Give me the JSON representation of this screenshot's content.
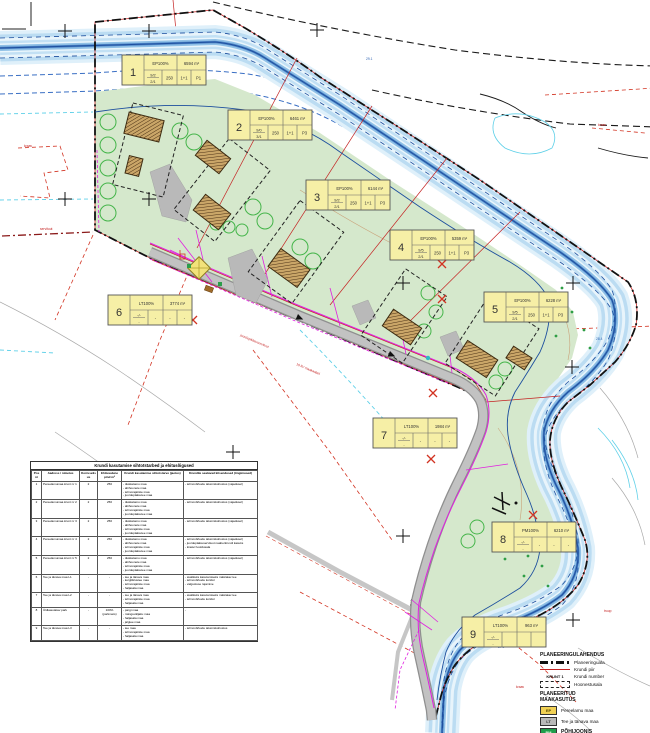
{
  "plots": [
    {
      "num": "1",
      "code": "EP100%",
      "area": "6594 m²",
      "fr_top": "9/2",
      "fr_bot": "2/1",
      "c2": "250",
      "c3": "1+1",
      "c4": "P1"
    },
    {
      "num": "2",
      "code": "EP100%",
      "area": "6461 m²",
      "fr_top": "9/0",
      "fr_bot": "3/1",
      "c2": "250",
      "c3": "1+1",
      "c4": "P3"
    },
    {
      "num": "3",
      "code": "EP100%",
      "area": "6144 m²",
      "fr_top": "9/2",
      "fr_bot": "2/1",
      "c2": "250",
      "c3": "1+1",
      "c4": "P3"
    },
    {
      "num": "4",
      "code": "EP100%",
      "area": "5359 m²",
      "fr_top": "9/5",
      "fr_bot": "2/1",
      "c2": "250",
      "c3": "1+1",
      "c4": "P3"
    },
    {
      "num": "5",
      "code": "EP100%",
      "area": "6228 m²",
      "fr_top": "9/5",
      "fr_bot": "2/1",
      "c2": "250",
      "c3": "1+1",
      "c4": "P3"
    },
    {
      "num": "6",
      "code": "LT100%",
      "area": "3774 m²",
      "fr_top": "-/-",
      "fr_bot": "-",
      "c2": "-",
      "c3": "-",
      "c4": "-"
    },
    {
      "num": "7",
      "code": "LT100%",
      "area": "1984 m²",
      "fr_top": "-/-",
      "fr_bot": "-",
      "c2": "-",
      "c3": "-",
      "c4": "-"
    },
    {
      "num": "8",
      "code": "PM100%",
      "area": "6210 m²",
      "fr_top": "-/-",
      "fr_bot": "-",
      "c2": "-",
      "c3": "-",
      "c4": "-"
    },
    {
      "num": "9",
      "code": "LT100%",
      "area": "963 m²",
      "fr_top": "-/-",
      "fr_bot": "-",
      "c2": "",
      "c3": "",
      "c4": ""
    }
  ],
  "table": {
    "title": "Krundi kasutamise sihtotstarbed ja ehitusõigused",
    "headers": [
      "Pos nr",
      "Aadress / nimetus",
      "Korruselisus",
      "Ehitusalune pind m²",
      "Krundi kasutamise sihtotstarve (jaotus)",
      "Krundile seatavad kitsendused (tingimused)"
    ],
    "rows": [
      [
        "1",
        "Pereelamumaa krunt nr 1",
        "2",
        "250",
        "- üksikelamu maa\n- abihoonete maa\n- tehnorajatiste maa\n- juurdepääsutee maa",
        "- tehnovõrkude talumiskohustus (vajadusel)"
      ],
      [
        "2",
        "Pereelamumaa krunt nr 2",
        "2",
        "250",
        "- üksikelamu maa\n- abihoonete maa\n- tehnorajatiste maa\n- juurdepääsutee maa",
        "- tehnovõrkude talumiskohustus (vajadusel)"
      ],
      [
        "3",
        "Pereelamumaa krunt nr 3",
        "2",
        "250",
        "- üksikelamu maa\n- abihoonete maa\n- tehnorajatiste maa\n- juurdepääsutee maa",
        "- tehnovõrkude talumiskohustus (vajadusel)"
      ],
      [
        "4",
        "Pereelamumaa krunt nr 4",
        "2",
        "250",
        "- üksikelamu maa\n- abihoonete maa\n- tehnorajatiste maa\n- juurdepääsutee maa",
        "- tehnovõrkude talumiskohustus (vajadusel)\n- juurdepääsuservituut naaberkrundi kasuks\n- kraavi hooldusala"
      ],
      [
        "5",
        "Pereelamumaa krunt nr 5",
        "2",
        "250",
        "- üksikelamu maa\n- abihoonete maa\n- tehnorajatiste maa\n- juurdepääsutee maa",
        "- tehnovõrkude talumiskohustus (vajadusel)"
      ],
      [
        "6",
        "Tee ja tänava maa L1",
        "-",
        "-",
        "- tee ja tänava maa\n- kergliiklustee maa\n- tehnorajatiste maa\n- haljasala maa",
        "- avalikuks kasutamiseks määratav tee\n- tehnovõrkude koridor\n- valgustuse rajamine"
      ],
      [
        "7",
        "Tee ja tänava maa L2",
        "-",
        "-",
        "- tee ja tänava maa\n- tehnorajatiste maa\n- haljasala maa",
        "- avalikuks kasutamiseks määratav tee\n- tehnovõrkude koridor"
      ],
      [
        "8",
        "Üldkasutatav park",
        "-",
        "100% (parkmets)",
        "- pargi maa\n- mänguväljaku maa\n- haljasala maa\n- jalgtee maa",
        "-"
      ],
      [
        "9",
        "Tee ja tänava maa L3",
        "-",
        "-",
        "- tee maa\n- tehnorajatiste maa\n- haljasala maa",
        "- tehnovõrkude talumiskohustus"
      ]
    ]
  },
  "legend": {
    "heading1": "PLANEERINGULAHENDUS",
    "item_planeeringuala": "Planeeringuala",
    "item_krundipiir": "Krundi piir",
    "krunt_symbol": "KRUNT 1",
    "item_krundinumber": "Krundi number",
    "item_hoonestusala": "Hoonestusala",
    "heading2a": "PLANEERITUD",
    "heading2b": "MAAKASUTUS",
    "ep_code": "EP",
    "ep_label": "Pereelamu maa",
    "lt_code": "LT",
    "lt_label": "Tee ja tänava maa",
    "pm_code": "PM",
    "drawing_title": "PÕHIJOONIS"
  },
  "map_labels": {
    "l1": "kraav",
    "l2": "servituut",
    "l3": "juurdepääsuservituut",
    "l4": "10 kV maakaabel",
    "l5": "truup",
    "l6": "kraav",
    "l7": "kraav",
    "e1": "29.1",
    "e2": "28.4",
    "e3": "27.9"
  },
  "colors": {
    "site_green": "#d5e8cc",
    "river_blue": "#8fc0e6",
    "boundary_black": "#111111",
    "plot_red": "#c42222",
    "utility_magenta": "#e020e0",
    "road_gray": "#b3b3b3",
    "infobox_yellow": "#f6efa6",
    "legend_ep": "#f0d054",
    "legend_lt": "#b9b9b9",
    "legend_pm": "#1f9e4b"
  }
}
